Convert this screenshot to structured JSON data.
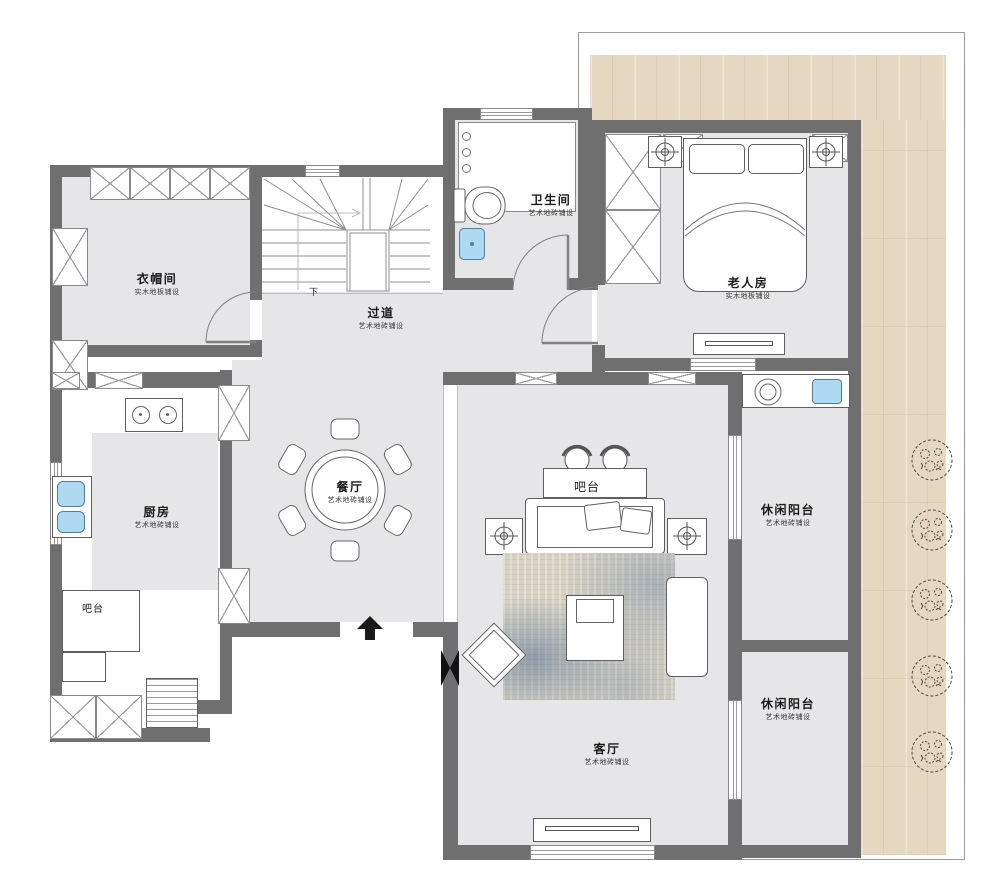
{
  "plan": {
    "type": "residential-floor-plan",
    "rooms": [
      {
        "id": "cloakroom",
        "name": "衣帽间",
        "sub": "实木地板铺设"
      },
      {
        "id": "hallway",
        "name": "过道",
        "sub": "艺术地砖铺设"
      },
      {
        "id": "bathroom",
        "name": "卫生间",
        "sub": "艺术地砖铺设"
      },
      {
        "id": "elder-bedroom",
        "name": "老人房",
        "sub": "实木地板铺设"
      },
      {
        "id": "kitchen",
        "name": "厨房",
        "sub": "艺术地砖铺设"
      },
      {
        "id": "dining-room",
        "name": "餐厅",
        "sub": "艺术地砖铺设"
      },
      {
        "id": "living-room",
        "name": "客厅",
        "sub": "艺术地砖铺设"
      },
      {
        "id": "balcony-upper",
        "name": "休闲阳台",
        "sub": "艺术地砖铺设"
      },
      {
        "id": "balcony-lower",
        "name": "休闲阳台",
        "sub": "艺术地砖铺设"
      }
    ],
    "labels": {
      "kitchen_bar": "吧台",
      "living_bar": "吧台",
      "stair_down": "下"
    },
    "colors": {
      "wall": "#6f6f6f",
      "room_floor": "#e6e6e8",
      "wood_deck": "#e6d8c0",
      "fixture_blue": "#aed9f0",
      "carpet": "#d8d2c2"
    }
  }
}
